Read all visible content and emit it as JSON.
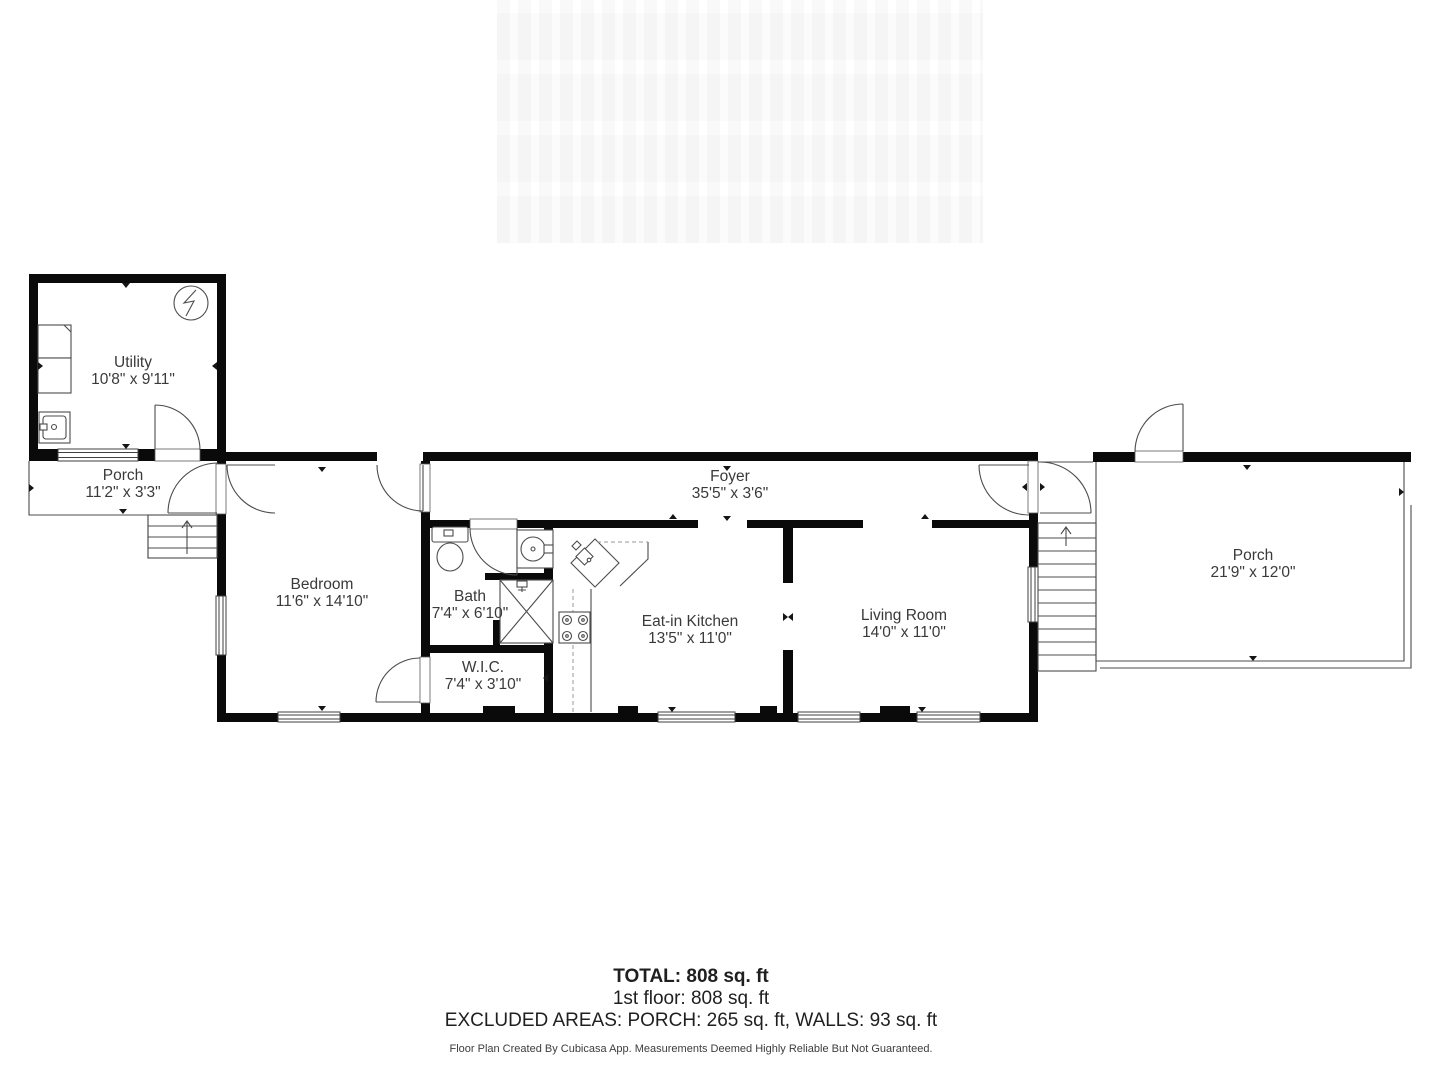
{
  "accent_colors": {
    "wall": "#0a0a0a",
    "line": "#4c4c4c",
    "text": "#3a3a3a"
  },
  "rooms": [
    {
      "name": "Utility",
      "dims": "10'8\" x 9'11\""
    },
    {
      "name": "Porch",
      "dims": "11'2\" x 3'3\""
    },
    {
      "name": "Bedroom",
      "dims": "11'6\" x 14'10\""
    },
    {
      "name": "Bath",
      "dims": "7'4\" x 6'10\""
    },
    {
      "name": "W.I.C.",
      "dims": "7'4\" x 3'10\""
    },
    {
      "name": "Foyer",
      "dims": "35'5\" x 3'6\""
    },
    {
      "name": "Eat-in Kitchen",
      "dims": "13'5\" x 11'0\""
    },
    {
      "name": "Living Room",
      "dims": "14'0\" x 11'0\""
    },
    {
      "name": "Porch",
      "dims": "21'9\" x 12'0\""
    }
  ],
  "summary": {
    "total": "TOTAL: 808 sq. ft",
    "floor": "1st floor: 808 sq. ft",
    "excluded": "EXCLUDED AREAS: PORCH: 265 sq. ft, WALLS: 93 sq. ft",
    "disclaimer": "Floor Plan Created By Cubicasa App. Measurements Deemed Highly Reliable But Not Guaranteed."
  }
}
